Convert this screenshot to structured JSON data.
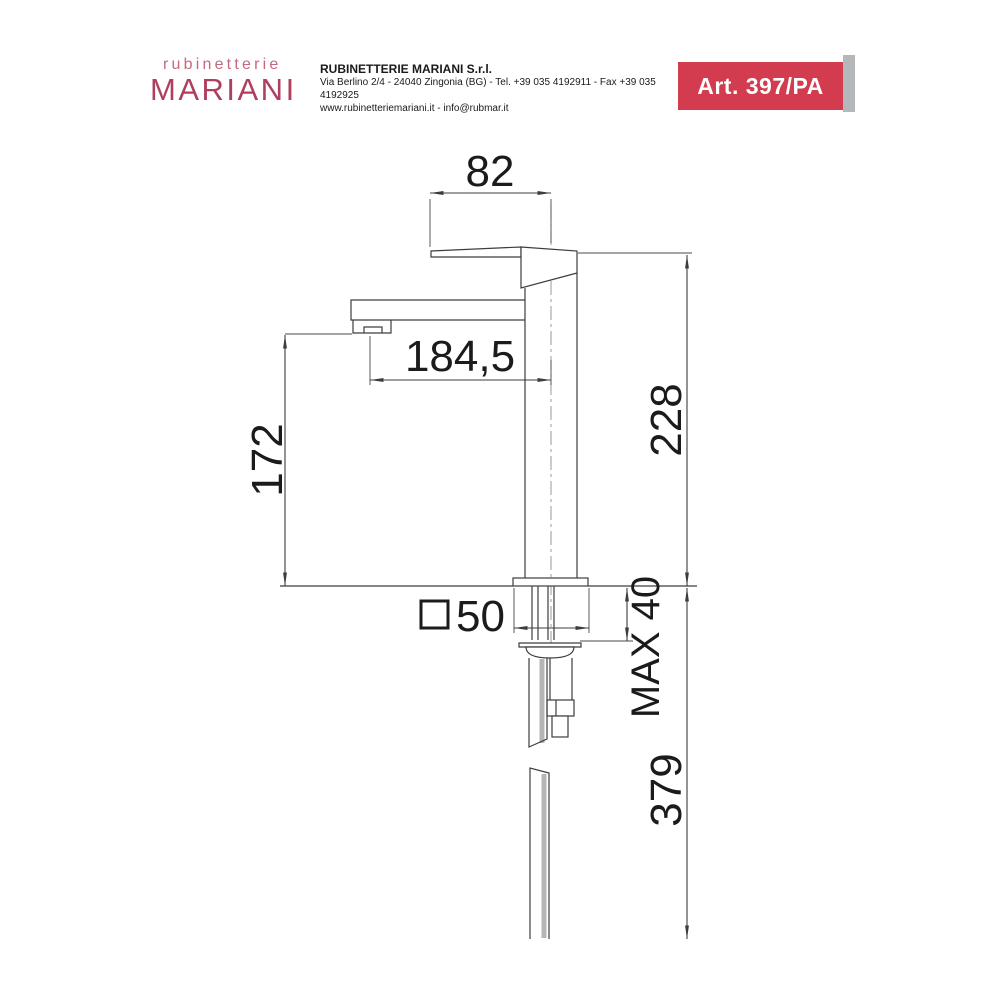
{
  "header": {
    "logo": {
      "top": "rubinetterie",
      "main": "MARIANI"
    },
    "company": {
      "name": "RUBINETTERIE MARIANI S.r.l.",
      "address": "Via Berlino 2/4 - 24040 Zingonia (BG) - Tel. +39 035 4192911 - Fax +39 035 4192925",
      "contacts": "www.rubinetteriemariani.it - info@rubmar.it"
    },
    "article": "Art. 397/PA"
  },
  "diagram": {
    "dims": {
      "handle_width": "82",
      "spout_reach": "184,5",
      "spout_height": "172",
      "body_height": "228",
      "base_side": "50",
      "max_counter": "MAX 40",
      "hose_length": "379"
    }
  },
  "colors": {
    "brand_pink": "#c4697e",
    "brand_red": "#ae405f",
    "badge_red": "#d23c4e",
    "badge_stripe": "#b4b8bb",
    "line": "#3d3d3d"
  }
}
